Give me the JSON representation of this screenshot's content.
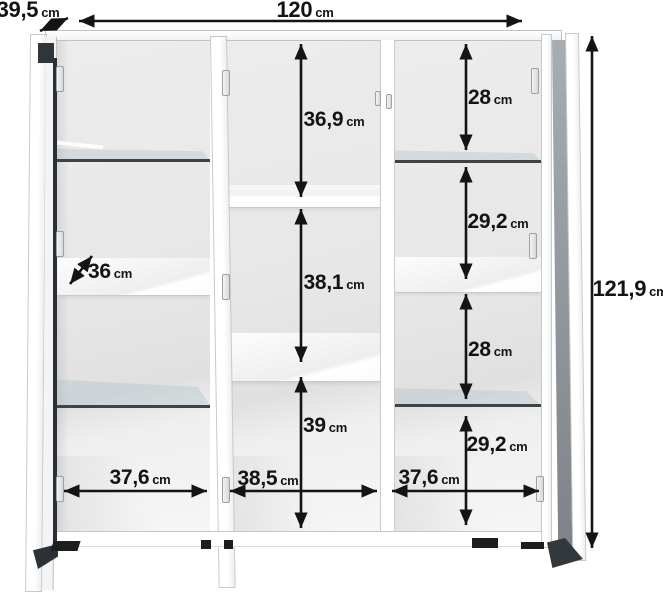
{
  "diagram": {
    "subject": "cabinet-dimension-diagram",
    "style": {
      "arrow_color": "#141414",
      "glass_edge_color": "#3f4346",
      "door_accent_color": "#30353a",
      "interior_color": "#e7e7e7",
      "background_color": "#ffffff"
    },
    "dims": {
      "overall_width": {
        "value": "120",
        "unit": "cm"
      },
      "overall_depth": {
        "value": "39,5",
        "unit": "cm"
      },
      "overall_height": {
        "value": "121,9",
        "unit": "cm"
      },
      "left_shelf_depth": {
        "value": "36",
        "unit": "cm"
      },
      "left_inner_width": {
        "value": "37,6",
        "unit": "cm"
      },
      "middle_top_height": {
        "value": "36,9",
        "unit": "cm"
      },
      "middle_middle_height": {
        "value": "38,1",
        "unit": "cm"
      },
      "middle_bottom_height": {
        "value": "39",
        "unit": "cm"
      },
      "middle_inner_width": {
        "value": "38,5",
        "unit": "cm"
      },
      "right_top_height": {
        "value": "28",
        "unit": "cm"
      },
      "right_upper_mid_height": {
        "value": "29,2",
        "unit": "cm"
      },
      "right_lower_mid_height": {
        "value": "28",
        "unit": "cm"
      },
      "right_bottom_height": {
        "value": "29,2",
        "unit": "cm"
      },
      "right_inner_width": {
        "value": "37,6",
        "unit": "cm"
      }
    }
  }
}
